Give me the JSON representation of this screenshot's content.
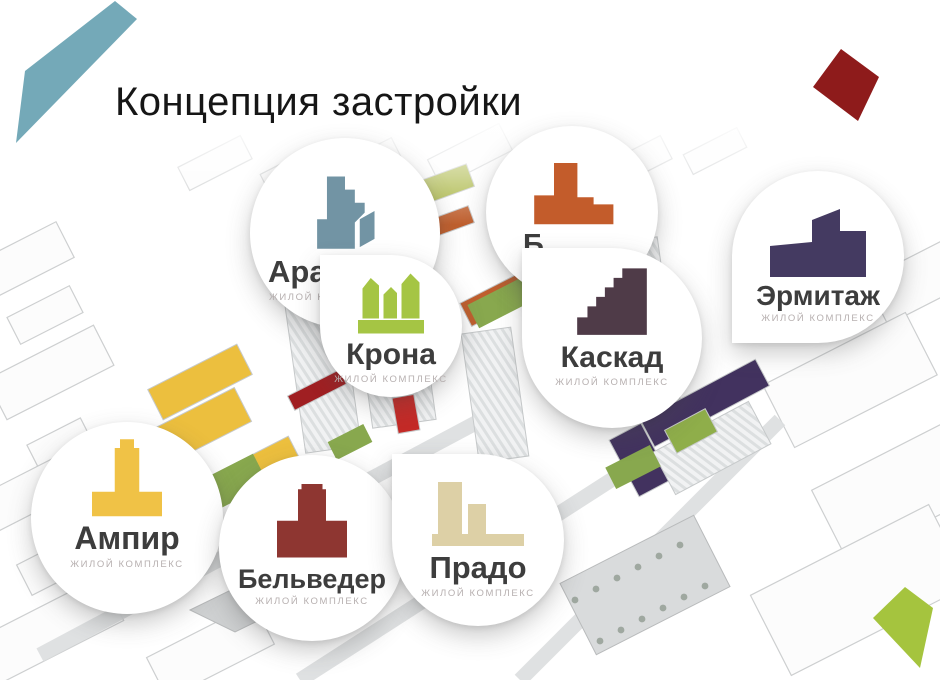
{
  "slide": {
    "title": "Концепция застройки"
  },
  "decor": {
    "nib_color": "#74a9b8",
    "diamond_color": "#8e1b1b",
    "kite_color": "#a5c43e"
  },
  "badges": [
    {
      "name": "Ара",
      "subtitle": "ЖИЛОЙ КОМПЛЕКС",
      "color": "#7294a4",
      "icon": "stepped-tower-building"
    },
    {
      "name": "Б",
      "subtitle": "ЖИЛОЙ КОМПЛЕКС",
      "color": "#c35c2b",
      "icon": "terraced-building"
    },
    {
      "name": "Крона",
      "subtitle": "ЖИЛОЙ КОМПЛЕКС",
      "color": "#a5c544",
      "icon": "three-towers-building"
    },
    {
      "name": "Каскад",
      "subtitle": "ЖИЛОЙ КОМПЛЕКС",
      "color": "#4f3b48",
      "icon": "staircase-building"
    },
    {
      "name": "Эрмитаж",
      "subtitle": "ЖИЛОЙ КОМПЛЕКС",
      "color": "#443a61",
      "icon": "slant-roof-tower-building"
    },
    {
      "name": "Ампир",
      "subtitle": "ЖИЛОЙ КОМПЛЕКС",
      "color": "#f0c246",
      "icon": "column-building"
    },
    {
      "name": "Бельведер",
      "subtitle": "ЖИЛОЙ КОМПЛЕКС",
      "color": "#8e3631",
      "icon": "pedestal-tower-building"
    },
    {
      "name": "Прадо",
      "subtitle": "ЖИЛОЙ КОМПЛЕКС",
      "color": "#ddd0a6",
      "icon": "two-towers-building"
    }
  ]
}
